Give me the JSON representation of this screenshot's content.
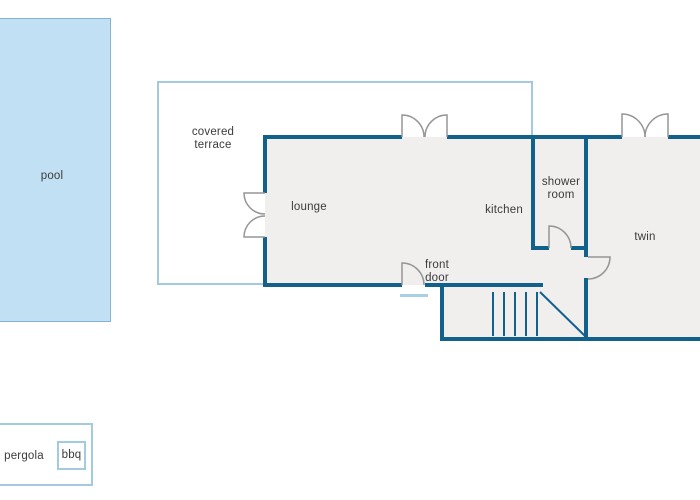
{
  "labels": {
    "pool": "pool",
    "covered_terrace": "covered terrace",
    "lounge": "lounge",
    "kitchen": "kitchen",
    "shower_room": "shower room",
    "twin": "twin",
    "front_door": "front door",
    "pergola": "pergola",
    "bbq": "bbq"
  },
  "colors": {
    "wall": "#11618b",
    "room_fill": "#f0efee",
    "pool_fill": "#c2e0f4",
    "pool_border": "#82b4d8",
    "outline_light": "#a3cbdf",
    "door": "#969696",
    "step": "#a8cfe4",
    "text": "#3b3b3b"
  }
}
